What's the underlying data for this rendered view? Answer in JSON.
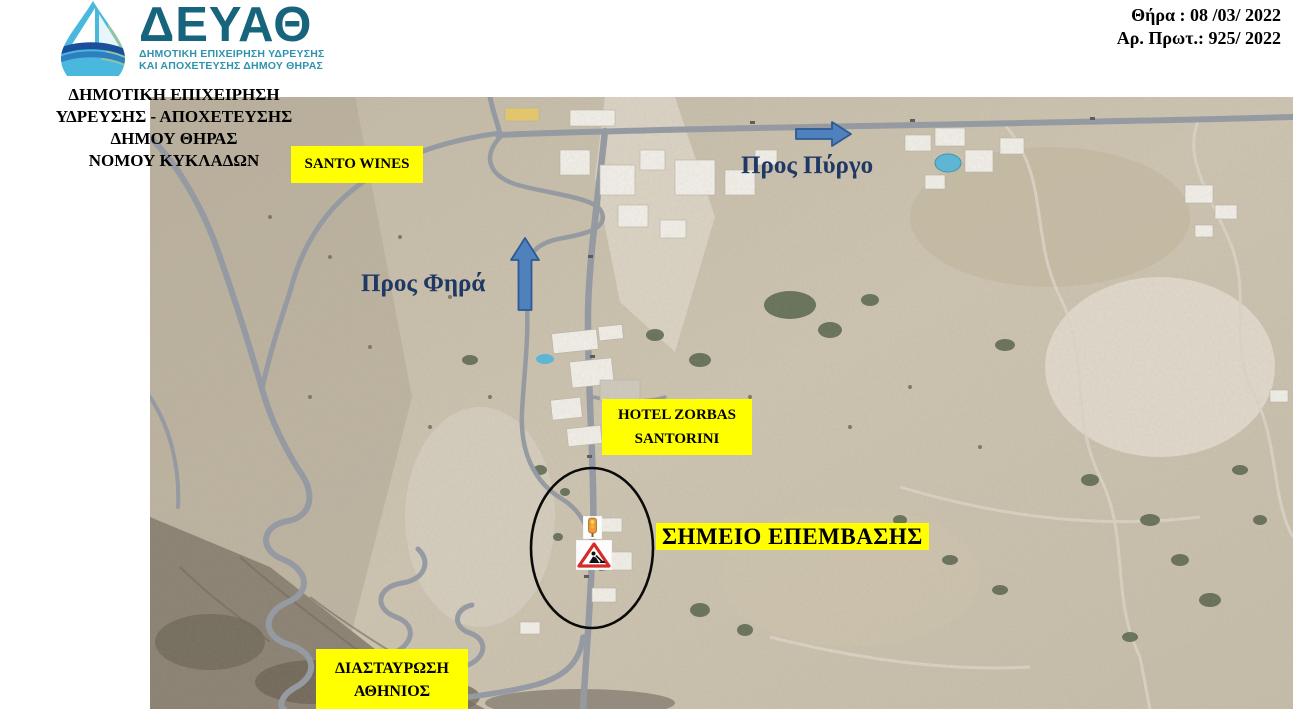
{
  "header": {
    "logo": {
      "acronym": "ΔΕΥΑΘ",
      "subtitle1": "ΔΗΜΟΤΙΚΗ ΕΠΙΧΕΙΡΗΣΗ ΥΔΡΕΥΣΗΣ",
      "subtitle2": "ΚΑΙ ΑΠΟΧΕΤΕΥΣΗΣ ΔΗΜΟΥ ΘΗΡΑΣ"
    },
    "org": {
      "line1": "ΔΗΜΟΤΙΚΗ ΕΠΙΧΕΙΡΗΣΗ",
      "line2": "ΥΔΡΕΥΣΗΣ - ΑΠΟΧΕΤΕΥΣΗΣ",
      "line3": "ΔΗΜΟΥ ΘΗΡΑΣ",
      "line4": "ΝΟΜΟΥ ΚΥΚΛΑΔΩΝ"
    },
    "date": {
      "line1": "Θήρα :  08 /03/ 2022",
      "line2": "Αρ. Πρωτ.: 925/ 2022"
    }
  },
  "map": {
    "labels": {
      "santo_wines": "SANTO WINES",
      "pros_pyrgo": "Προς Πύργο",
      "pros_fira": "Προς Φηρά",
      "hotel_line1": "HOTEL ZORBAS",
      "hotel_line2": "SANTORINI",
      "intervention_point": "ΣΗΜΕΙΟ ΕΠΕΜΒΑΣΗΣ",
      "junction_line1": "ΔΙΑΣΤΑΥΡΩΣΗ",
      "junction_line2": "ΑΘΗΝΙΟΣ"
    },
    "icons": {
      "arrow_right": "arrow-right-icon",
      "arrow_up": "arrow-up-icon",
      "traffic_light": "traffic-light-icon",
      "roadworks_sign": "roadworks-sign-icon",
      "intervention_circle": "ellipse-annotation"
    },
    "colors": {
      "label_background": "#ffff00",
      "direction_text": "#1f3864",
      "arrow_fill": "#4f81bd",
      "arrow_outline": "#2e5a94",
      "annotation_circle": "#000000",
      "logo_teal": "#17657c"
    }
  }
}
